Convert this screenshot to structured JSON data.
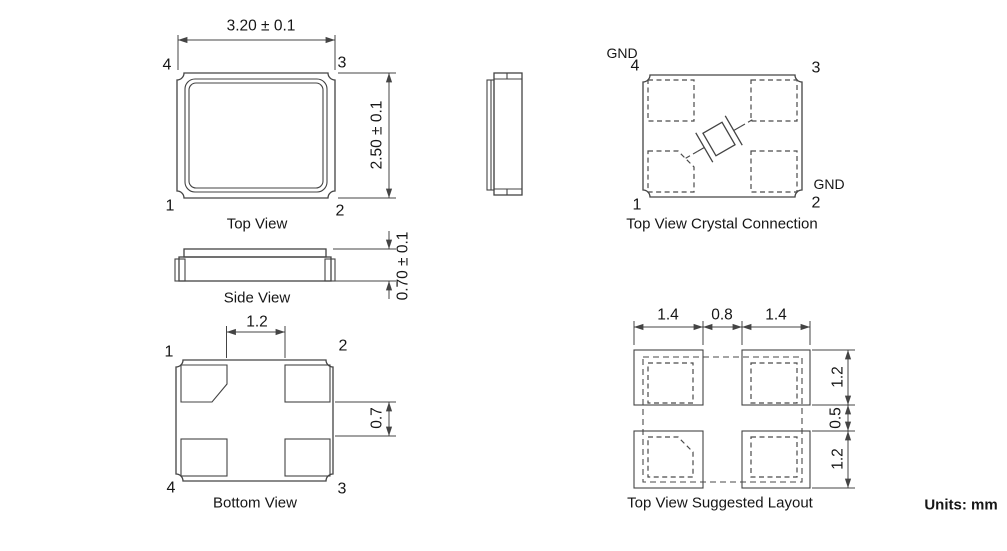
{
  "units_label": "Units: mm",
  "top_view": {
    "title": "Top View",
    "dim_width": "3.20 ± 0.1",
    "dim_height": "2.50 ± 0.1",
    "pin1": "1",
    "pin2": "2",
    "pin3": "3",
    "pin4": "4"
  },
  "side_view": {
    "title": "Side View",
    "dim_thickness": "0.70 ± 0.1"
  },
  "bottom_view": {
    "title": "Bottom View",
    "dim_pad_inner_gap": "1.2",
    "dim_pad_corner": "0.7",
    "pin1": "1",
    "pin2": "2",
    "pin3": "3",
    "pin4": "4"
  },
  "crystal_connection": {
    "title": "Top View Crystal Connection",
    "gnd_pin4": "GND",
    "gnd_pin2": "GND",
    "pin1": "1",
    "pin2": "2",
    "pin3": "3",
    "pin4": "4"
  },
  "suggested_layout": {
    "title": "Top View Suggested Layout",
    "dim_pad_width_left": "1.4",
    "dim_pad_gap_h": "0.8",
    "dim_pad_width_right": "1.4",
    "dim_pad_height_top": "1.2",
    "dim_pad_gap_v": "0.5",
    "dim_pad_height_bottom": "1.2"
  }
}
